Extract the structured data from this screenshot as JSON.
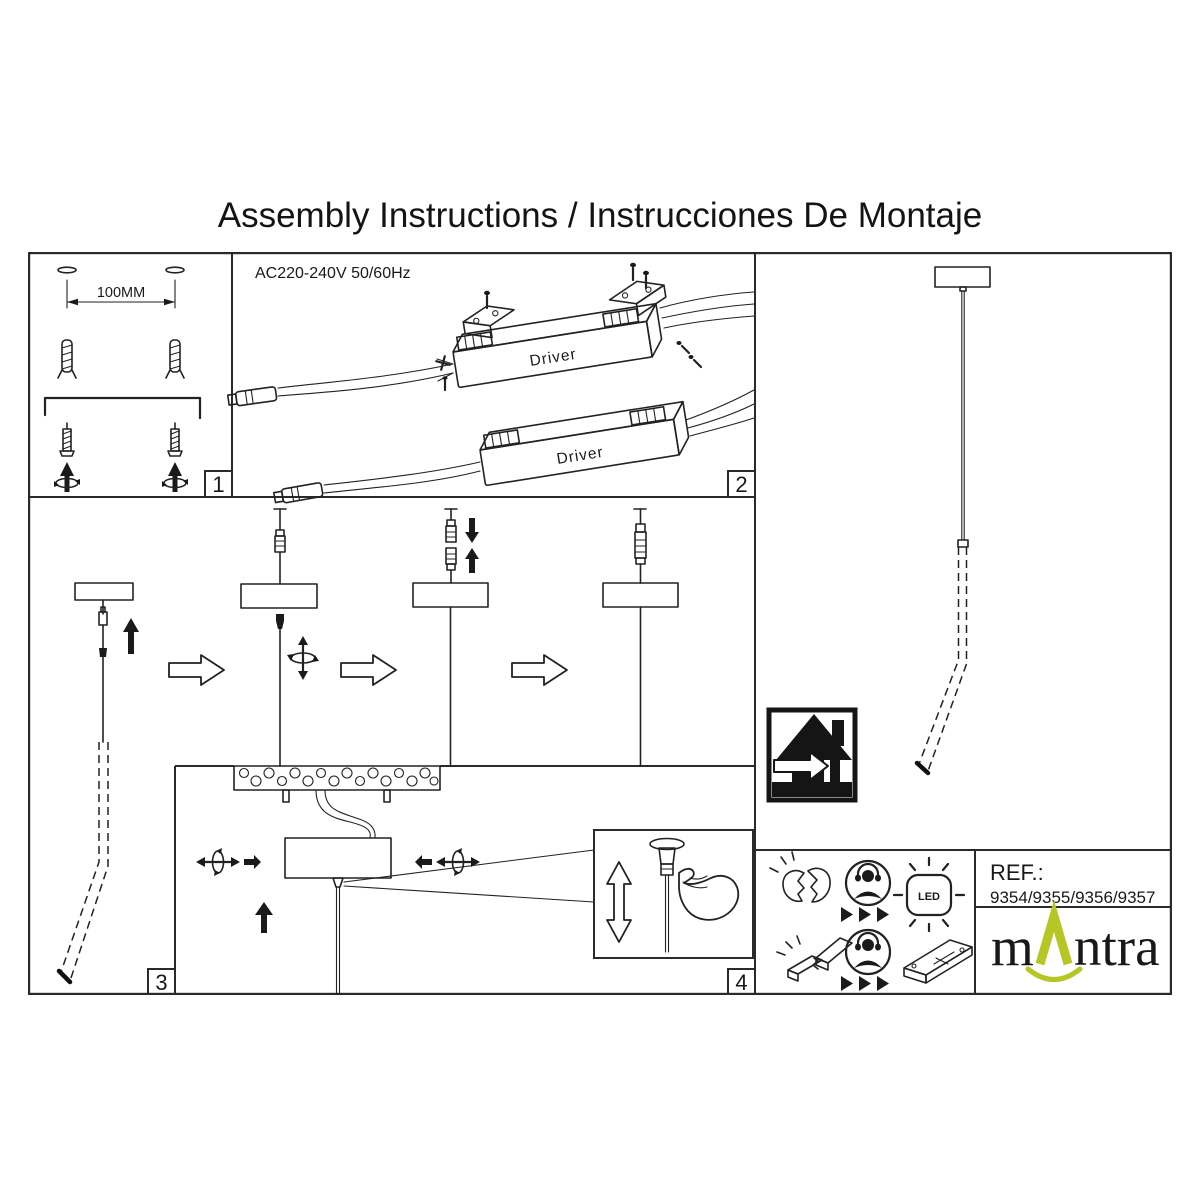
{
  "page": {
    "title": "Assembly Instructions / Instrucciones De Montaje",
    "background": "#ffffff",
    "line_color": "#222222"
  },
  "panel1": {
    "number": "1",
    "dim_label": "100MM"
  },
  "panel2": {
    "number": "2",
    "power_label": "AC220-240V 50/60Hz",
    "driver1_label": "Driver",
    "driver2_label": "Driver"
  },
  "panel3": {
    "number": "3"
  },
  "panel4": {
    "number": "4"
  },
  "footer": {
    "ref_label": "REF.:",
    "ref_numbers": "9354/9355/9356/9357",
    "led_label": "LED",
    "brand": {
      "prefix": "m",
      "suffix": "ntra",
      "accent": "#b5c625",
      "text_color": "#1b1b1b"
    }
  },
  "icons": {
    "footer_row1": [
      "broken-lamp-icon",
      "service-person-icon",
      "triple-arrow-icon",
      "led-icon"
    ],
    "footer_row2": [
      "broken-driver-icon",
      "service-person-icon",
      "triple-arrow-icon",
      "driver-icon"
    ],
    "right_panel": [
      "indoor-use-icon"
    ]
  }
}
